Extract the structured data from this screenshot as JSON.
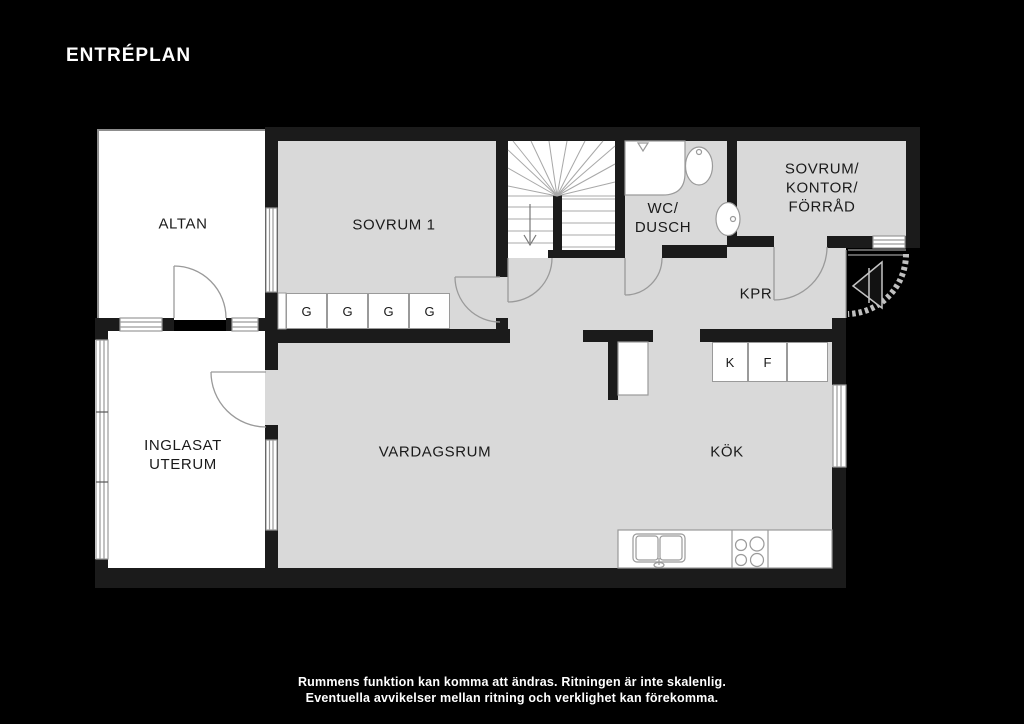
{
  "page": {
    "background": "#000000",
    "title": "ENTRÉPLAN",
    "footer": {
      "line1": "Rummens funktion kan komma att ändras. Ritningen är inte skalenlig.",
      "line2": "Eventuella avvikelser mellan ritning och verklighet kan förekomma."
    }
  },
  "colors": {
    "wall": "#1b1b1b",
    "interior_fill": "#d9d9d9",
    "outdoor_fill": "#ffffff",
    "thin_line": "#9a9a9a",
    "label_text": "#1a1a1a",
    "title_text": "#ffffff"
  },
  "rooms": {
    "altan": {
      "label": "ALTAN"
    },
    "sovrum1": {
      "label": "SOVRUM 1"
    },
    "wc": {
      "line1": "WC/",
      "line2": "DUSCH"
    },
    "sovrum2": {
      "line1": "SOVRUM/",
      "line2": "KONTOR/",
      "line3": "FÖRRÅD"
    },
    "kpr": {
      "label": "KPR"
    },
    "uterum": {
      "line1": "INGLASAT",
      "line2": "UTERUM"
    },
    "vardagsrum": {
      "label": "VARDAGSRUM"
    },
    "kok": {
      "label": "KÖK"
    }
  },
  "storage": {
    "wardrobes": [
      "G",
      "G",
      "G",
      "G"
    ],
    "kitchen_units": [
      "K",
      "F",
      ""
    ]
  }
}
